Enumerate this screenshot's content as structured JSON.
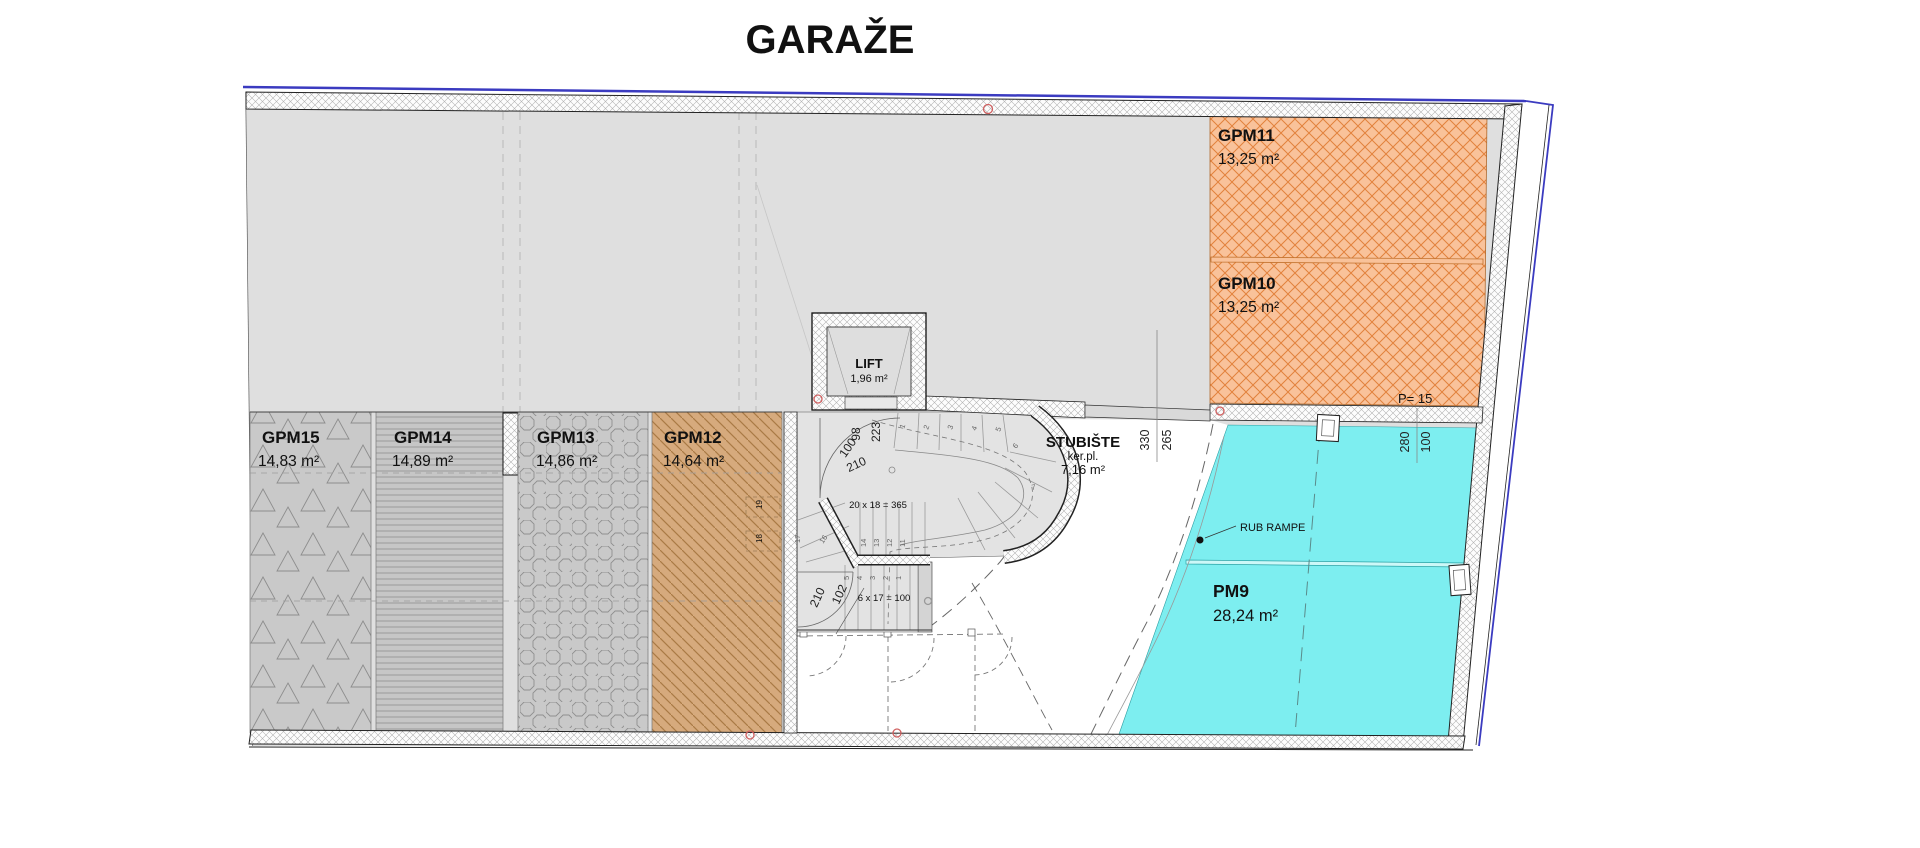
{
  "title": "GARAŽE",
  "parking_spots": [
    {
      "id": "GPM15",
      "area": "14,83 m²",
      "pattern": "triangles"
    },
    {
      "id": "GPM14",
      "area": "14,89 m²",
      "pattern": "horizontal-lines"
    },
    {
      "id": "GPM13",
      "area": "14,86 m²",
      "pattern": "octagons"
    },
    {
      "id": "GPM12",
      "area": "14,64 m²",
      "pattern": "diagonal-lines"
    },
    {
      "id": "GPM11",
      "area": "13,25 m²",
      "pattern": "orange-crosshatch"
    },
    {
      "id": "GPM10",
      "area": "13,25 m²",
      "pattern": "orange-crosshatch"
    },
    {
      "id": "PM9",
      "area": "28,24 m²",
      "pattern": "cyan-solid"
    }
  ],
  "rooms": {
    "lift": {
      "name": "LIFT",
      "area": "1,96 m²"
    },
    "stairwell": {
      "name": "STUBIŠTE",
      "floor": "ker.pl.",
      "area": "7,16 m²"
    }
  },
  "annotations": {
    "p15": "P= 15",
    "rub_rampe": "RUB RAMPE",
    "stair_main": "20 x 18 = 365",
    "stair_lower": "6 x 17 = 100"
  },
  "dimensions": {
    "lift_door_w": "98",
    "lift_door_h": "223",
    "stair_door_w": "100",
    "stair_door_h": "210",
    "lower_door_w": "102",
    "lower_door_h": "210",
    "stub_dim_a": "330",
    "stub_dim_b": "265",
    "pm9_dim_a": "280",
    "pm9_dim_b": "100"
  },
  "steps": {
    "upper": [
      "1",
      "2",
      "3",
      "4",
      "5",
      "6",
      "7"
    ],
    "mid": [
      "14",
      "13",
      "12",
      "11"
    ],
    "left": [
      "17",
      "16"
    ],
    "lower": [
      "5",
      "4",
      "3",
      "2",
      "1"
    ],
    "dashed": [
      "19",
      "18"
    ]
  },
  "colors": {
    "orange": "#f9c29a",
    "orange_line": "#e2813c",
    "cyan": "#7deef0",
    "tan": "#d6aa7d",
    "gray_floor": "#dfdfdf",
    "boundary_navy": "#3b3bc0"
  }
}
